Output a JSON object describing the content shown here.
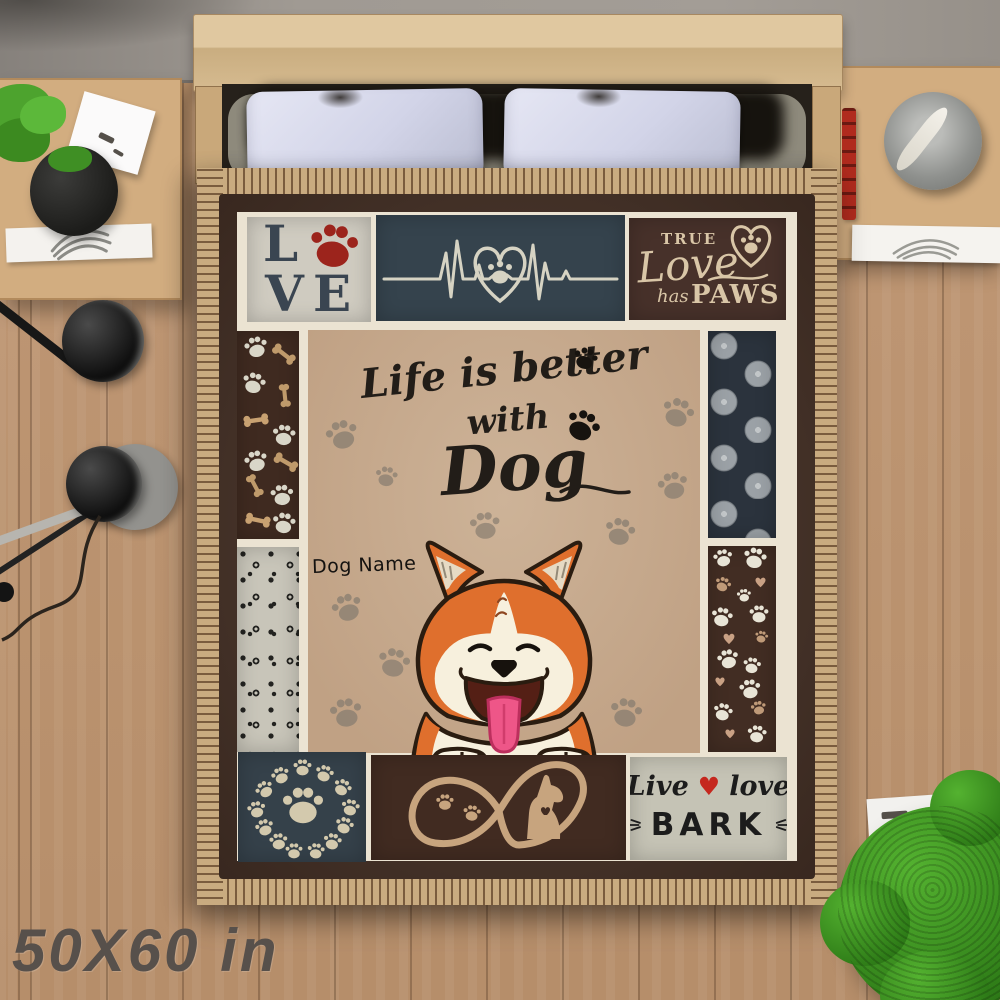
{
  "product": {
    "size_label": "50X60 in"
  },
  "blanket": {
    "love_panel": {
      "l": "L",
      "v": "V",
      "e": "E"
    },
    "true_love_panel": {
      "w1": "TRUE",
      "w2": "Love",
      "w3": "has",
      "w4": "PAWS"
    },
    "quote_panel": {
      "l1": "Life is better",
      "l2": "with",
      "l3": "Dog"
    },
    "dog_name": "Dog Name",
    "bark_panel": {
      "w1": "Live",
      "heart": "♥",
      "w2": "love",
      "w3": "BARK"
    }
  },
  "colors": {
    "paw_red": "#9c241c",
    "heart_red": "#c5271e",
    "dog_orange": "#df6f2d",
    "panel_navy": "#35434d",
    "panel_brown": "#47312a",
    "panel_tan": "#c6ac91",
    "panel_gray": "#cfcbc0",
    "fringe_tan": "#c9ab80",
    "border_brown": "#4e372b"
  }
}
